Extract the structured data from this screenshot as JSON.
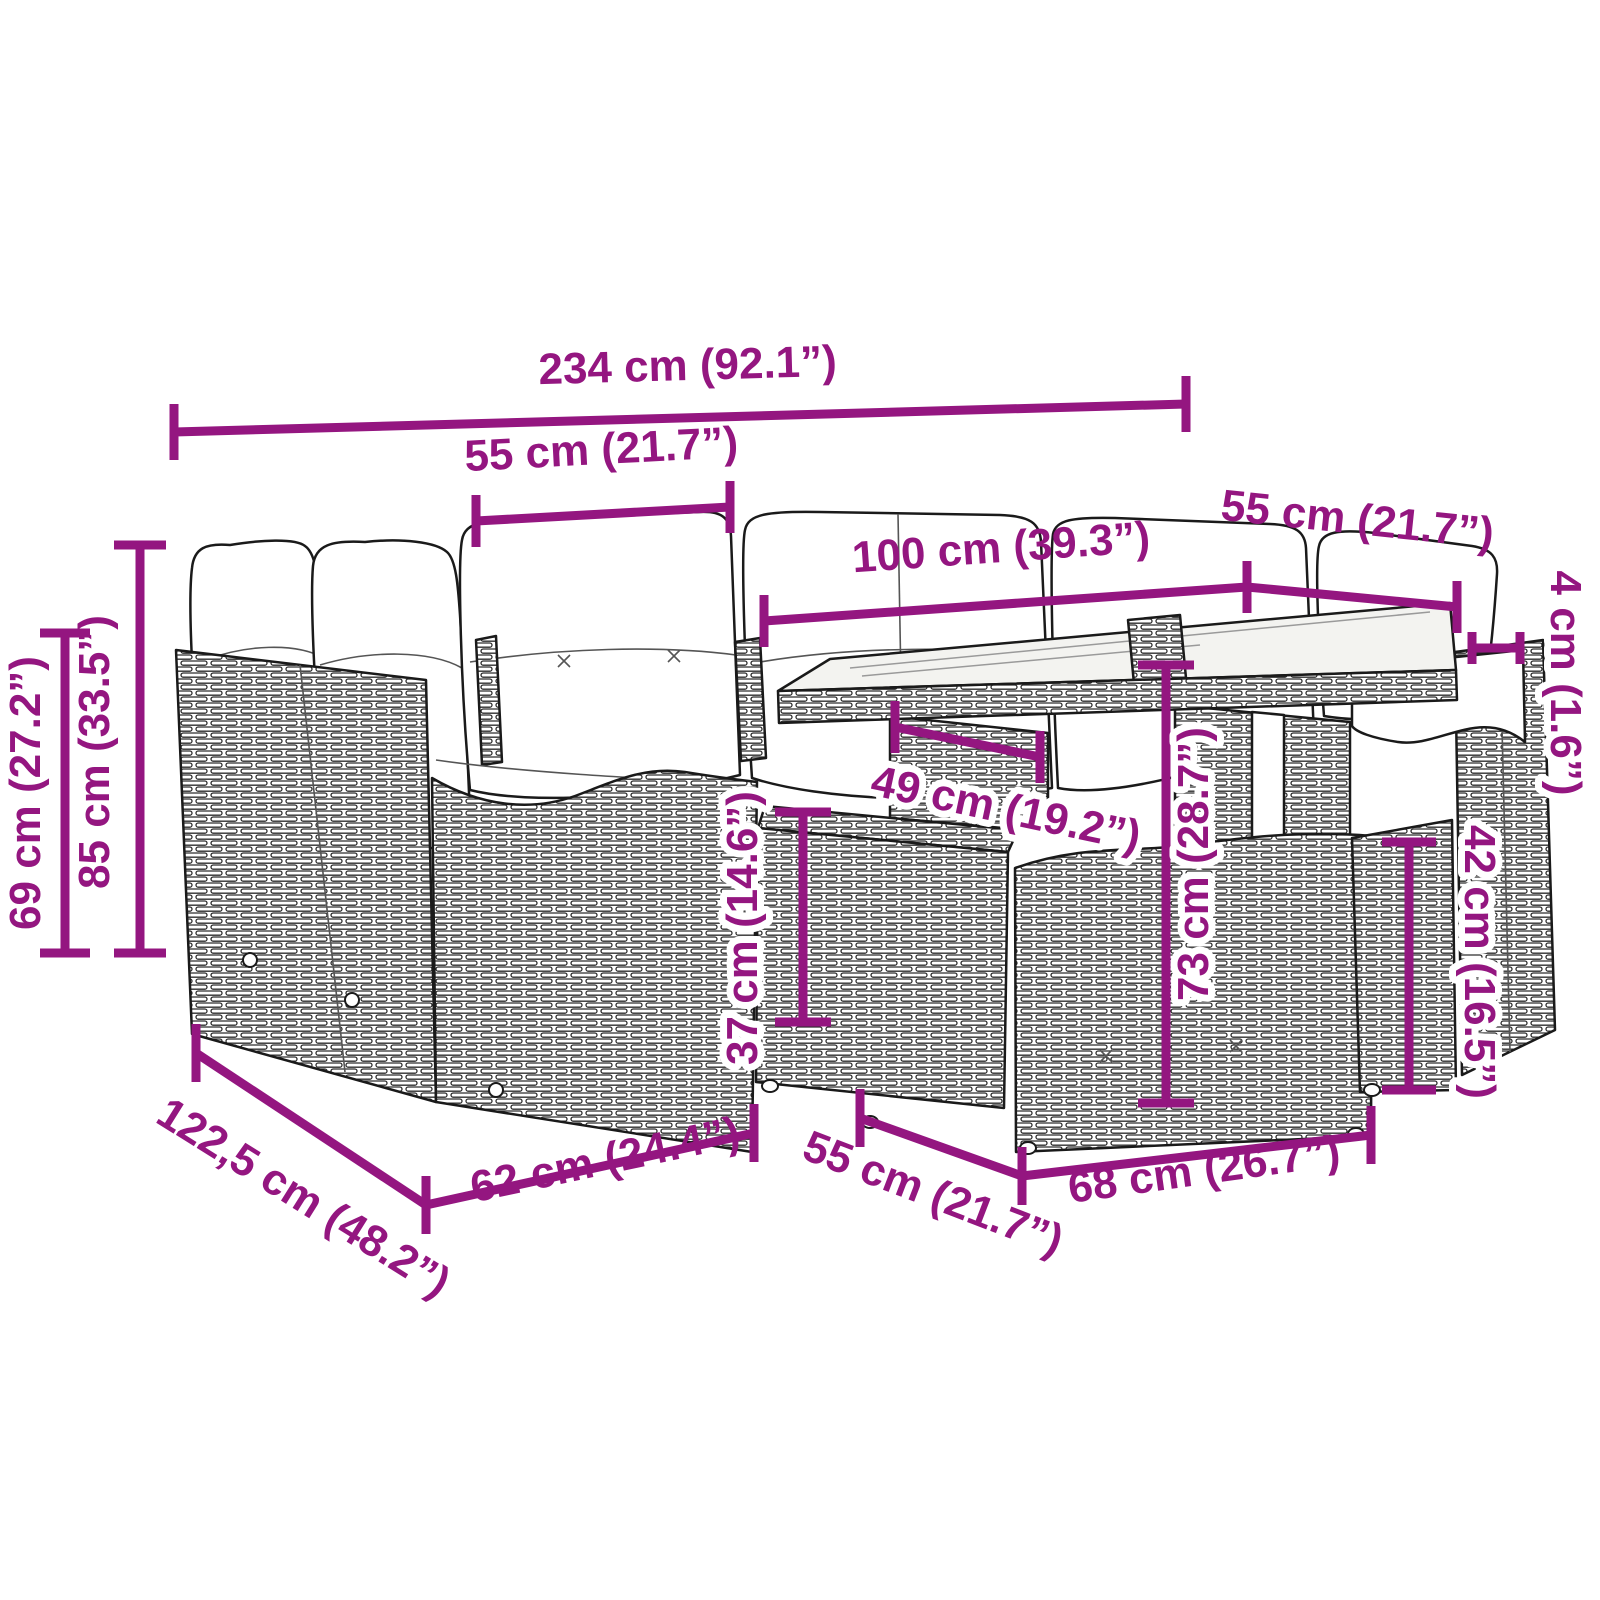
{
  "figure": {
    "type": "product-dimension-diagram",
    "subject": "Poly rattan garden lounge set with white cushions, glass-top table, footstool and ottomans",
    "view": "three-quarter line-art illustration with magenta dimension lines"
  },
  "palette": {
    "dimension_color": "#941680",
    "art_line_color": "#1a1a1a",
    "cushion_color": "#ffffff",
    "glass_color": "#f3f3f0",
    "background": "#ffffff"
  },
  "dimensions": {
    "total_width": {
      "label": "234 cm (92.1”)"
    },
    "seat_cushion_width": {
      "label": "55 cm (21.7”)"
    },
    "table_length": {
      "label": "100 cm (39.3”)"
    },
    "corner_seat_width": {
      "label": "55 cm (21.7”)"
    },
    "tabletop_thickness": {
      "label": "4 cm (1.6”)"
    },
    "arm_height": {
      "label": "69 cm (27.2”)"
    },
    "back_height": {
      "label": "85 cm (33.5”)"
    },
    "table_clearance": {
      "label": "49 cm (19.2”)"
    },
    "footstool_height": {
      "label": "37 cm (14.6”)"
    },
    "table_height": {
      "label": "73 cm (28.7”)"
    },
    "ottoman_height": {
      "label": "42 cm (16.5”)"
    },
    "total_depth": {
      "label": "122,5 cm (48.2”)"
    },
    "module_width": {
      "label": "62 cm (24.4”)"
    },
    "footstool_width": {
      "label": "55 cm (21.7”)"
    },
    "ottoman_width": {
      "label": "68 cm (26.7”)"
    }
  }
}
